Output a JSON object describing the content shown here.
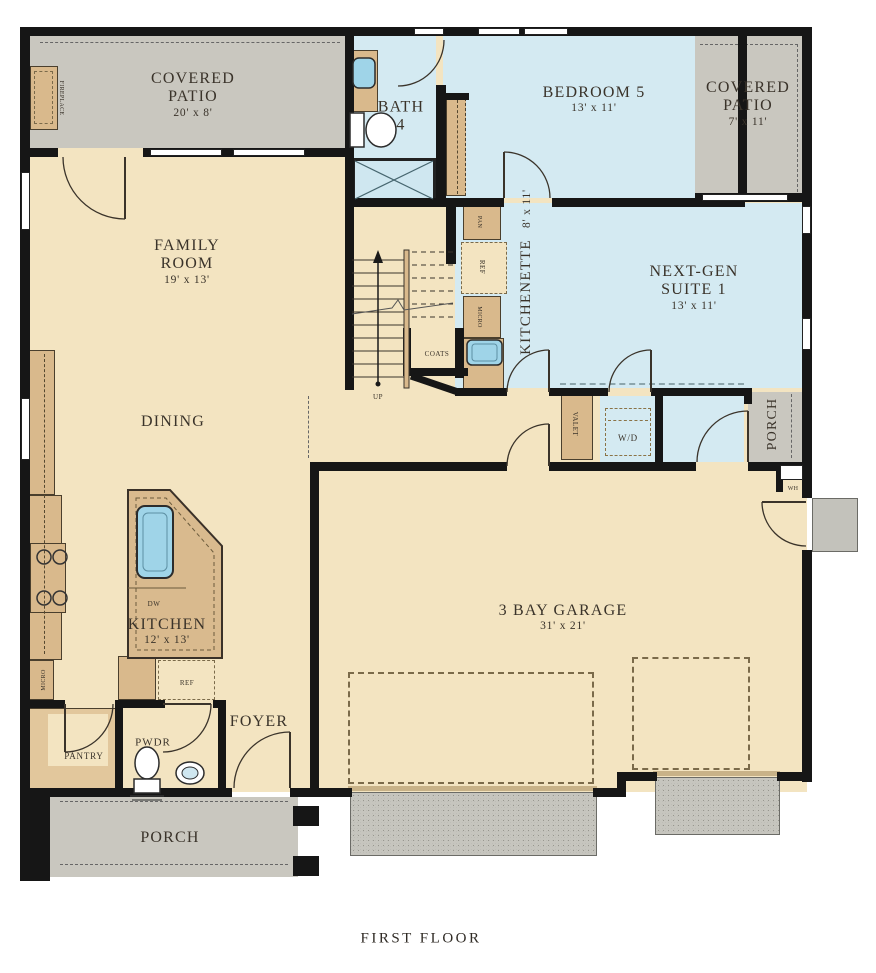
{
  "caption": "FIRST FLOOR",
  "rooms": {
    "covered_patio_left": {
      "name": "COVERED PATIO",
      "dims": "20' x 8'"
    },
    "bath_4": {
      "name": "BATH 4"
    },
    "bedroom_5": {
      "name": "BEDROOM 5",
      "dims": "13' x 11'"
    },
    "covered_patio_right": {
      "name": "COVERED PATIO",
      "dims": "7' x 11'"
    },
    "family_room": {
      "name": "FAMILY ROOM",
      "dims": "19' x 13'"
    },
    "kitchenette": {
      "name": "KITCHENETTE",
      "dims": "8' x 11'"
    },
    "next_gen_suite": {
      "name": "NEXT-GEN SUITE 1",
      "dims": "13' x 11'"
    },
    "porch_right": {
      "name": "PORCH"
    },
    "dining": {
      "name": "DINING"
    },
    "kitchen": {
      "name": "KITCHEN",
      "dims": "12' x 13'"
    },
    "garage": {
      "name": "3 BAY GARAGE",
      "dims": "31' x 21'"
    },
    "foyer": {
      "name": "FOYER"
    },
    "powder": {
      "name": "PWDR"
    },
    "pantry": {
      "name": "PANTRY"
    },
    "porch_front": {
      "name": "PORCH"
    }
  },
  "fixtures": {
    "fireplace": "FIREPLACE",
    "pantry_cabinet": "PAN",
    "kitchenette_fridge": "REF",
    "kitchenette_microwave": "MICRO",
    "coats_closet": "COATS",
    "stairs_direction": "UP",
    "valet": "VALET",
    "washer_dryer": "W/D",
    "water_heater": "WH",
    "kitchen_microwave": "MICRO",
    "kitchen_fridge": "REF",
    "dishwasher": "DW"
  },
  "colors": {
    "floor": "#f3e4c1",
    "patio_gray": "#c9c7bf",
    "blue_room": "#d4eaf2",
    "cabinet_tan": "#d9b98c",
    "wall_black": "#161616",
    "concrete": "#c6c5be",
    "sink_blue": "#9fd4e8"
  }
}
